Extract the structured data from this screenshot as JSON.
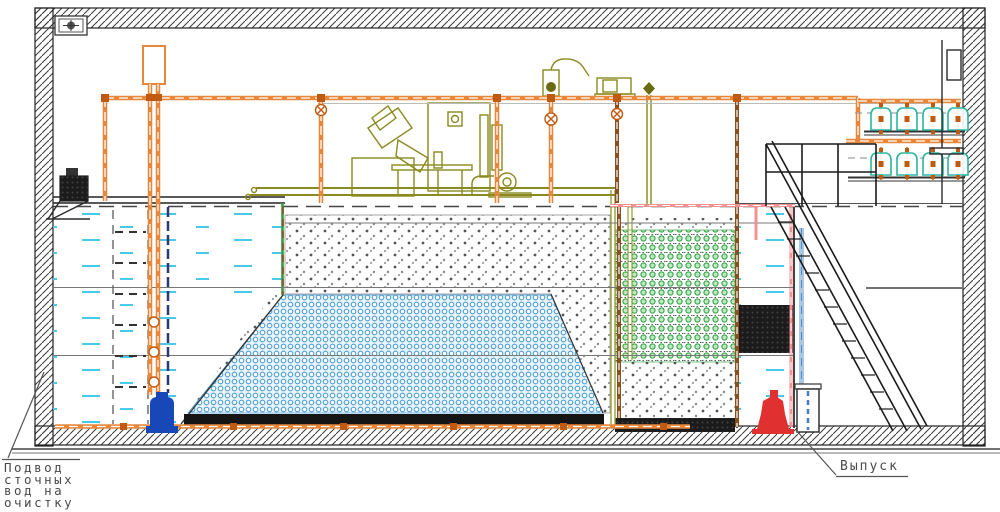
{
  "drawing": {
    "type": "wastewater-treatment-plant-section",
    "labels": {
      "inlet": {
        "line1": "Подвод",
        "line2": "сточных",
        "line3": "вод на",
        "line4": "очистку"
      },
      "outlet": {
        "text": "Выпуск"
      }
    },
    "colors": {
      "pipe_orange": "#E8873A",
      "pipe_brown": "#8A5020",
      "pipe_pink": "#F49090",
      "pipe_lightblue": "#A8C8E8",
      "water_dash_cyan": "#49C9E8",
      "media_blue_ring": "#4F9FD4",
      "media_green": "#28A038",
      "equipment_olive": "#8A8A20",
      "diffuser_teal": "#2AB5A0",
      "pump_blue": "#1848B8",
      "pump_red": "#E03030",
      "wall_hatch": "#3A3A3A"
    },
    "counts": {
      "diffuser_rows": 2,
      "diffusers_per_row": 4
    }
  }
}
